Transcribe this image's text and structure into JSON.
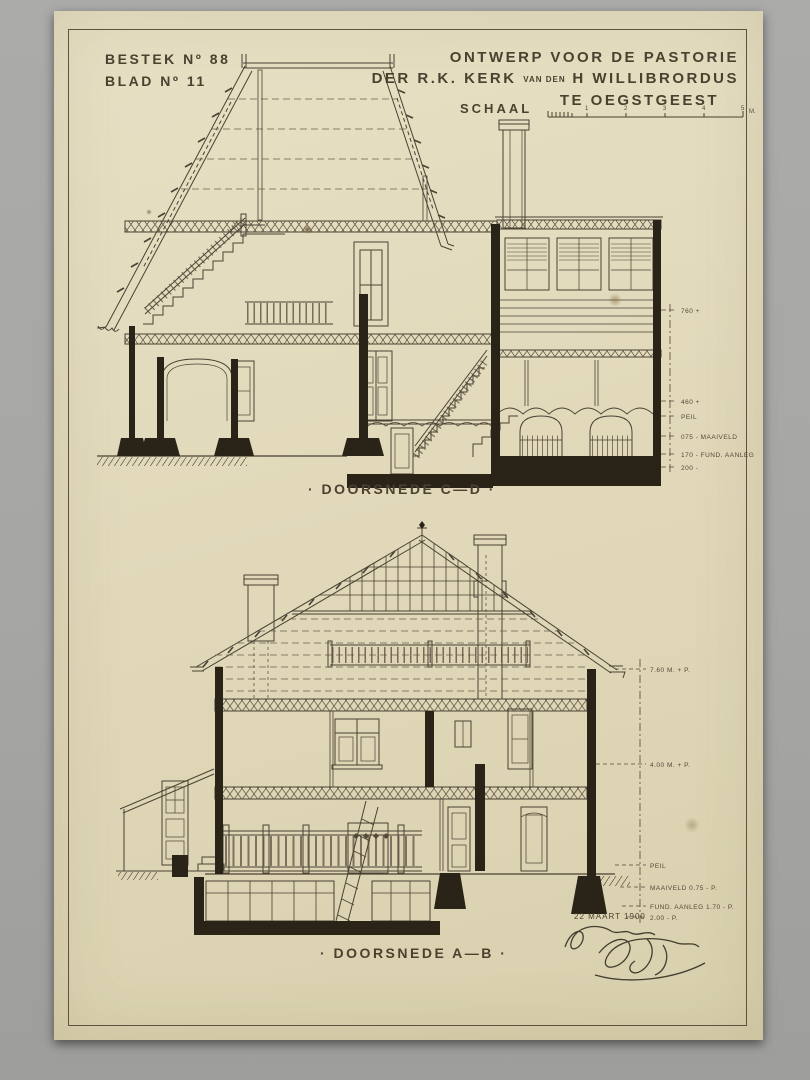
{
  "sheet": {
    "bestek": "BESTEK Nº 88",
    "blad": "BLAD Nº 11",
    "title": {
      "line1": "ONTWERP VOOR DE PASTORIE",
      "line2_a": "DER  R.K. KERK",
      "line2_small": "VAN DEN",
      "line2_b": "H WILLIBRORDUS",
      "line3": "TE OEGSTGEEST"
    },
    "scale": {
      "label": "SCHAAL",
      "numbers": [
        "1",
        "2",
        "3",
        "4",
        "5"
      ],
      "unit": "M."
    },
    "date": "22 MAART 1900"
  },
  "sections": {
    "top": {
      "caption": "· DOORSNEDE C—D ·",
      "levels": [
        "760 +",
        "460 +",
        "PEIL",
        "075 - MAAIVELD",
        "170 - FUND. AANLEG",
        "200 -"
      ]
    },
    "bottom": {
      "caption": "· DOORSNEDE A—B ·",
      "levels": [
        "7.60 M. + P.",
        "4.00 M. + P.",
        "PEIL",
        "MAAIVELD 0.75 - P.",
        "FUND. AANLEG 1.70 - P.",
        "2.00 - P."
      ]
    }
  }
}
